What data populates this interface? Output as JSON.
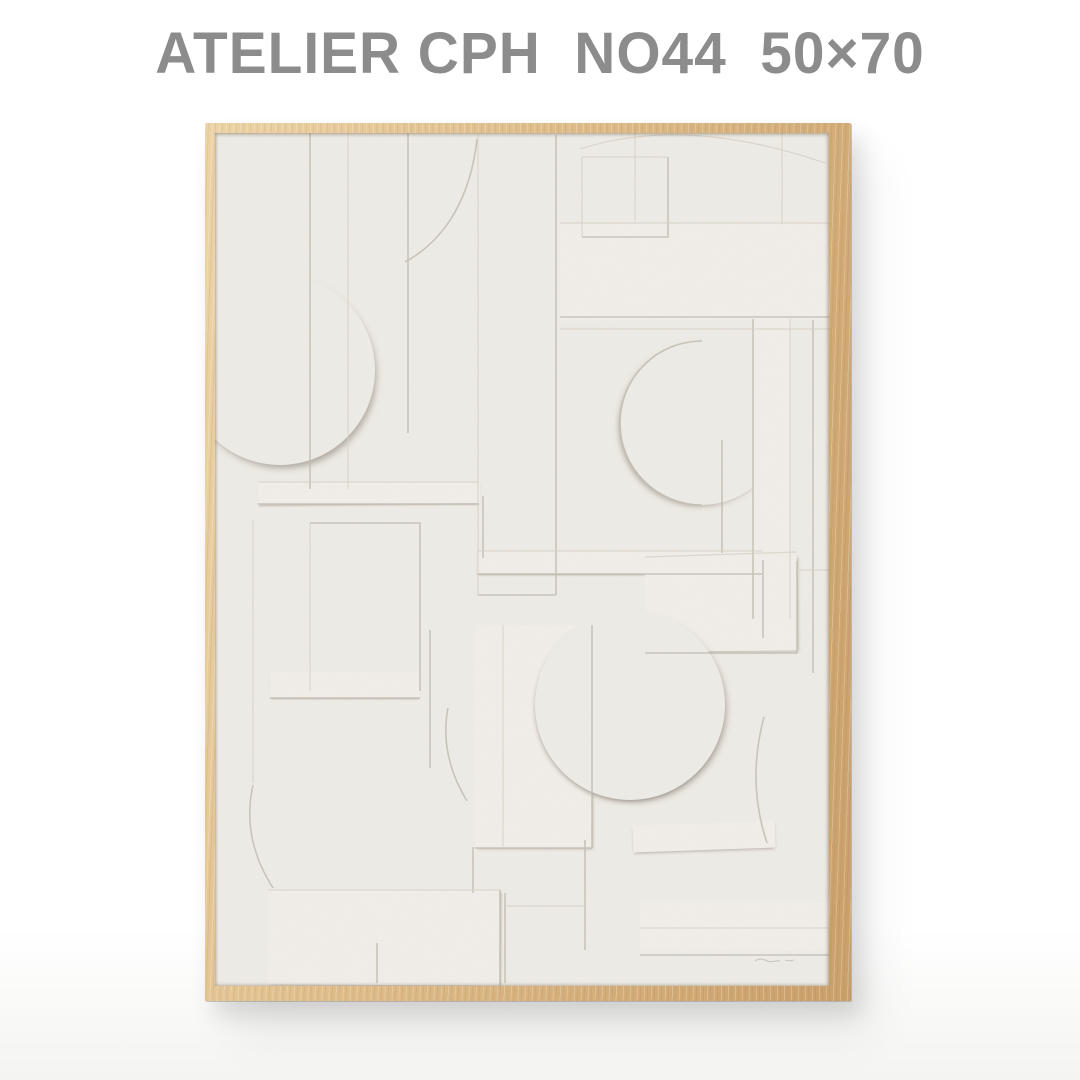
{
  "header": {
    "title": "ATELIER CPH  NO44  50×70"
  },
  "colors": {
    "page-bg": "#ffffff",
    "page-bg-bottom": "#f4f4f2",
    "title-gray": "#8c8c8c",
    "frame-light": "#ecd3a6",
    "frame-mid": "#ddba87",
    "frame-dark": "#c99f6a",
    "paper": "#efece6",
    "paper-raised": "#f2efe9",
    "line-dark": "#c3beb3",
    "line-soft": "#d8d3c8"
  }
}
